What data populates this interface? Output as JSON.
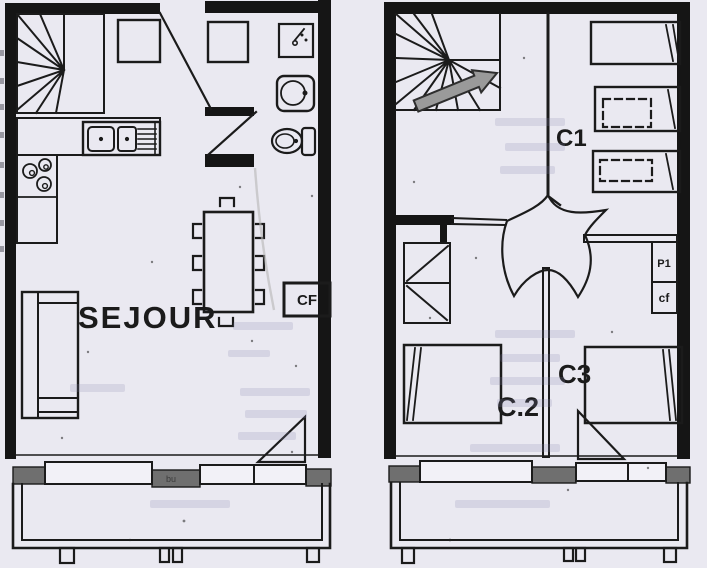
{
  "canvas": {
    "width": 707,
    "height": 568
  },
  "colors": {
    "paper": "#eae9f1",
    "ink": "#1b1b1b",
    "wall_fill": "#151515",
    "pier_gray": "#6f6f6f",
    "arrow_gray": "#9a9a9a",
    "ghost_text": "#8585ad"
  },
  "left_unit": {
    "room_label": "SEJOUR",
    "storage_label": "CF",
    "balcony_pier_label": "bu",
    "fixture_icons": [
      "winder-staircase-icon",
      "double-sink-icon",
      "drainboard-icon",
      "cooktop-burners-icon",
      "entry-closet-icon",
      "shower-icon",
      "washbasin-icon",
      "toilet-icon",
      "dining-table-icon",
      "chair-icon",
      "sofa-icon",
      "window-icon",
      "balcony-icon",
      "door-swing-icon"
    ]
  },
  "right_unit": {
    "rooms": [
      {
        "label": "C1"
      },
      {
        "label": "C.2"
      },
      {
        "label": "C3"
      }
    ],
    "closets": [
      {
        "label": "P1"
      },
      {
        "label": "cf"
      }
    ],
    "fixture_icons": [
      "winder-staircase-icon",
      "direction-arrow-icon",
      "single-bed-icon",
      "bunk-bed-dashed-icon",
      "wardrobe-icon",
      "door-swing-icon",
      "window-icon",
      "balcony-icon"
    ]
  }
}
